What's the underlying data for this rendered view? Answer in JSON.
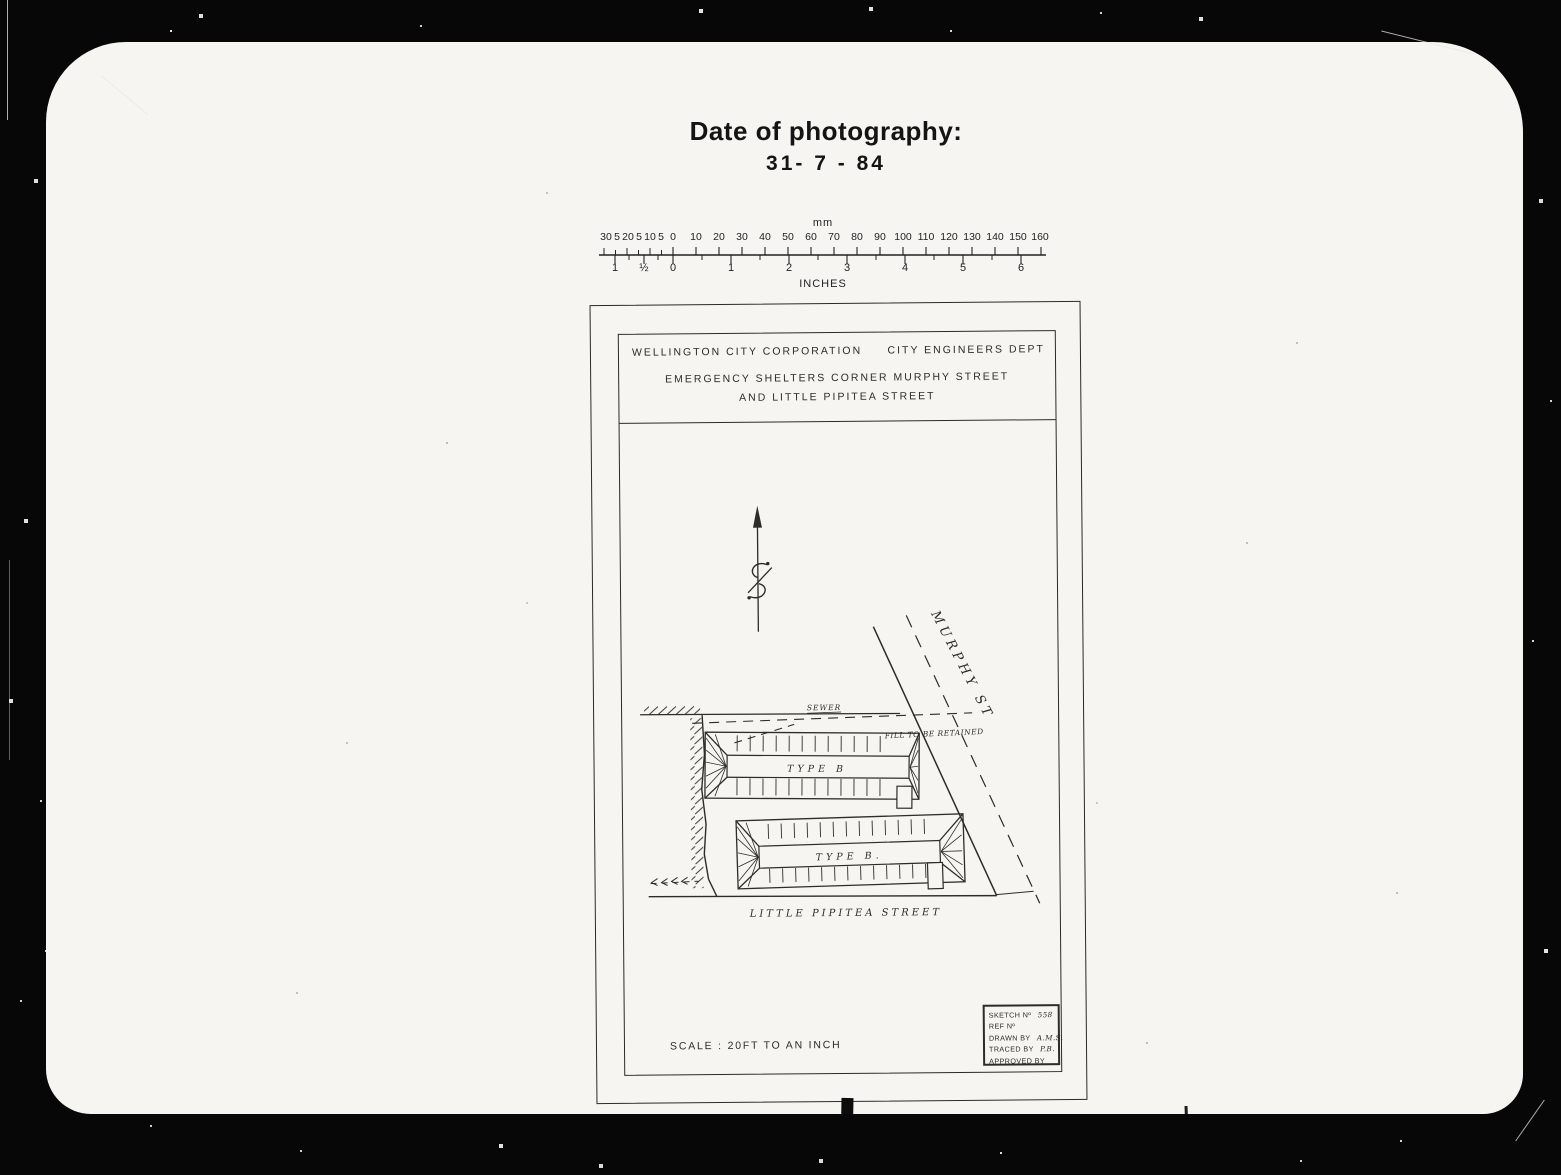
{
  "caption": {
    "title": "Date of photography:",
    "date": "31- 7 - 84"
  },
  "ruler": {
    "unit_top": "mm",
    "unit_bottom": "INCHES",
    "mm_labels": [
      "30",
      "5",
      "20",
      "5",
      "10",
      "5",
      "0",
      "10",
      "20",
      "30",
      "40",
      "50",
      "60",
      "70",
      "80",
      "90",
      "100",
      "110",
      "120",
      "130",
      "140",
      "150",
      "160"
    ],
    "inch_labels": [
      "1",
      "½",
      "0",
      "1",
      "2",
      "3",
      "4",
      "5",
      "6"
    ]
  },
  "sheet": {
    "header": {
      "org": "WELLINGTON CITY CORPORATION",
      "dept": "CITY ENGINEERS DEPT",
      "subtitle1": "EMERGENCY SHELTERS CORNER MURPHY STREET",
      "subtitle2": "AND LITTLE PIPITEA STREET"
    },
    "plan": {
      "street1": "MURPHY ST",
      "street2": "LITTLE PIPITEA STREET",
      "sewer": "SEWER",
      "fill_note": "FILL TO BE RETAINED",
      "building1": "TYPE B",
      "building2": "TYPE B."
    },
    "title_block": {
      "sketch_label": "SKETCH Nº",
      "sketch_no": "558",
      "ref_label": "REF Nº",
      "drawn_label": "DRAWN BY",
      "drawn_by": "A.M.S.",
      "traced_label": "TRACED BY",
      "traced_by": "P.B.",
      "approved_label": "APPROVED BY"
    },
    "scale_note": "SCALE : 20FT TO AN INCH"
  },
  "margin_marks": [
    "AO",
    "AO",
    "AO",
    "AO",
    "AO"
  ]
}
